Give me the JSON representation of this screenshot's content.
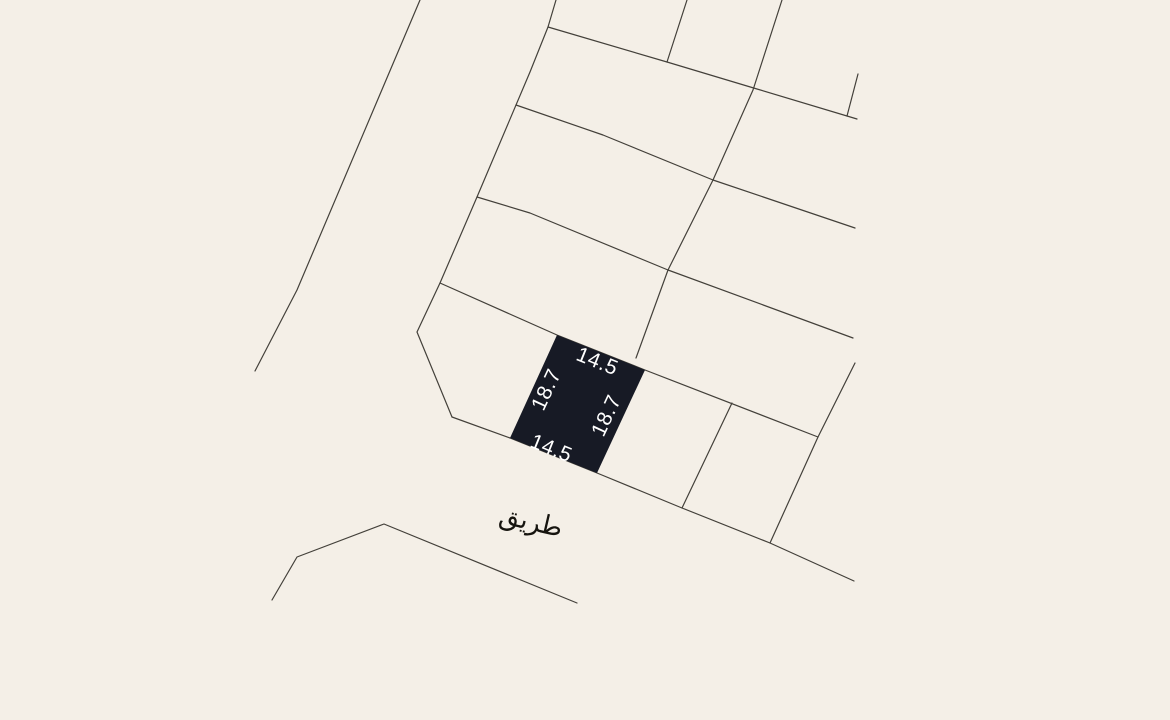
{
  "canvas": {
    "width": 1170,
    "height": 720,
    "background_color": "#f4efe7",
    "line_color": "#43403a"
  },
  "map": {
    "road_label": {
      "text": "طريق",
      "x": 531,
      "y": 522,
      "rotation_deg": 13,
      "font_size": 26,
      "color": "#16140f"
    },
    "highlighted_parcel": {
      "fill_color": "#171a25",
      "points": [
        [
          557,
          335
        ],
        [
          645,
          370
        ],
        [
          597,
          473
        ],
        [
          510,
          438
        ]
      ],
      "label_color": "#ffffff",
      "label_font_size": 21,
      "dimension_labels": [
        {
          "side": "top",
          "text": "14.5",
          "x": 597,
          "y": 362,
          "rotation_deg": 22
        },
        {
          "side": "left",
          "text": "18.7",
          "x": 547,
          "y": 390,
          "rotation_deg": -65
        },
        {
          "side": "right",
          "text": "18.7",
          "x": 607,
          "y": 416,
          "rotation_deg": -65
        },
        {
          "side": "bottom",
          "text": "14.5",
          "x": 551,
          "y": 449,
          "rotation_deg": 22
        }
      ]
    },
    "boundary_lines": [
      {
        "name": "west-road-edge",
        "points": [
          [
            420,
            0
          ],
          [
            297,
            290
          ],
          [
            255,
            371
          ]
        ]
      },
      {
        "name": "block-west-boundary",
        "points": [
          [
            556,
            0
          ],
          [
            548,
            27
          ],
          [
            530,
            72
          ],
          [
            477,
            197
          ],
          [
            440,
            283
          ],
          [
            417,
            332
          ],
          [
            452,
            417
          ]
        ]
      },
      {
        "name": "south-road-edge",
        "points": [
          [
            452,
            417
          ],
          [
            510,
            438
          ],
          [
            597,
            473
          ],
          [
            682,
            508
          ],
          [
            770,
            543
          ],
          [
            854,
            581
          ]
        ]
      },
      {
        "name": "row-line-north",
        "points": [
          [
            548,
            27
          ],
          [
            667,
            62
          ],
          [
            757,
            89
          ],
          [
            857,
            119
          ]
        ]
      },
      {
        "name": "north-east-stub",
        "points": [
          [
            858,
            74
          ],
          [
            847,
            116
          ]
        ]
      },
      {
        "name": "row-line-middle",
        "points": [
          [
            516,
            105
          ],
          [
            603,
            135
          ],
          [
            713,
            180
          ],
          [
            855,
            228
          ]
        ]
      },
      {
        "name": "row-line-lower",
        "points": [
          [
            477,
            197
          ],
          [
            530,
            213
          ],
          [
            668,
            270
          ],
          [
            853,
            338
          ]
        ]
      },
      {
        "name": "cross-street-line",
        "points": [
          [
            782,
            0
          ],
          [
            753,
            90
          ],
          [
            713,
            180
          ],
          [
            668,
            270
          ],
          [
            636,
            358
          ]
        ]
      },
      {
        "name": "north-stub",
        "points": [
          [
            687,
            0
          ],
          [
            667,
            62
          ]
        ]
      },
      {
        "name": "parcel-row-top-edge",
        "points": [
          [
            440,
            283
          ],
          [
            557,
            335
          ],
          [
            645,
            370
          ],
          [
            818,
            437
          ]
        ]
      },
      {
        "name": "east-divider",
        "points": [
          [
            855,
            363
          ],
          [
            818,
            437
          ],
          [
            770,
            543
          ]
        ]
      },
      {
        "name": "mid-divider",
        "points": [
          [
            732,
            403
          ],
          [
            682,
            508
          ]
        ]
      },
      {
        "name": "south-west-block-edge",
        "points": [
          [
            272,
            600
          ],
          [
            297,
            557
          ],
          [
            384,
            524
          ],
          [
            577,
            603
          ]
        ]
      }
    ]
  }
}
